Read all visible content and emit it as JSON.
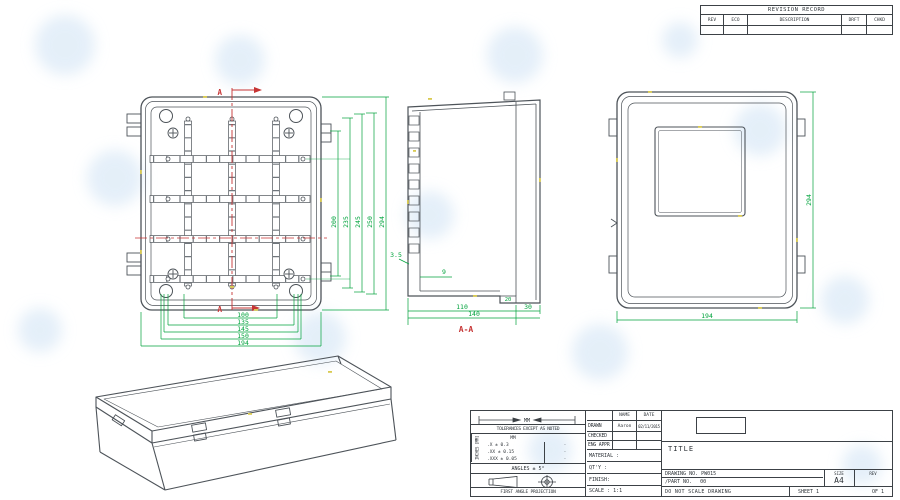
{
  "revision_table": {
    "title": "REVISION RECORD",
    "columns": [
      "REV",
      "ECO",
      "DESCRIPTION",
      "DRFT",
      "CHKD"
    ]
  },
  "views": {
    "front": {
      "section_mark_top": "A",
      "section_mark_bottom": "A",
      "dims_right": [
        "200",
        "235",
        "245",
        "250",
        "294"
      ],
      "dims_bottom": [
        "100",
        "135",
        "145",
        "150",
        "194"
      ]
    },
    "section": {
      "label": "A-A",
      "dim_rib": "3.5",
      "dim_depth": "9",
      "dim_step": "20",
      "dim_body": "110",
      "dim_total": "140",
      "dim_lid": "30"
    },
    "back": {
      "dim_height": "294",
      "dim_width": "194"
    }
  },
  "title_block": {
    "units_label": "MM",
    "side_label": "INCHES [MM]",
    "tolerances_note": "TOLERANCES EXCEPT AS NOTED",
    "tol_header": "MM",
    "tolerances": [
      ".X ± 0.3",
      ".XX ± 0.15",
      ".XXX ± 0.05"
    ],
    "tolerances_in": [
      "·",
      "·",
      "·"
    ],
    "angles": "ANGLES ± 5°",
    "projection": "FIRST ANGLE PROJECTION",
    "name_header": "NAME",
    "date_header": "DATE",
    "drawn_label": "DRAWN",
    "drawn_name": "Aaron",
    "drawn_date": "02/11/2015",
    "checked_label": "CHECKED",
    "eng_appr_label": "ENG APPR",
    "material_label": "MATERIAL :",
    "qty_label": "QT'Y :",
    "finish_label": "FINISH:",
    "scale_label": "SCALE : 1:1",
    "title_label": "TITLE",
    "drawing_no_label": "DRAWING NO.",
    "drawing_no": "PW015",
    "part_no_label": "/PART NO.",
    "part_no": "00",
    "size_label": "SIZE",
    "size_value": "A4",
    "rev_label": "REV",
    "do_not_scale": "DO NOT SCALE DRAWING",
    "sheet_label": "SHEET 1",
    "of_label": "OF 1"
  },
  "colors": {
    "dimension_green": "#00a33c",
    "centerline_red": "#c63434",
    "drawing_line": "#4d5359",
    "highlight_yellow": "#d9ca52",
    "watermark_blue": "#cfe2f4"
  }
}
